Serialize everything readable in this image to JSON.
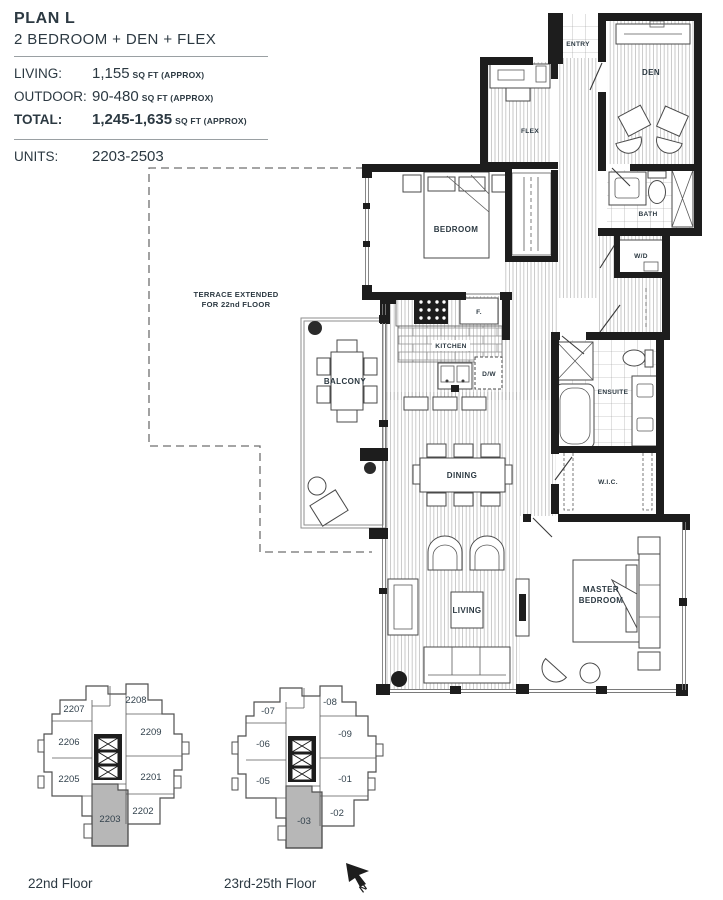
{
  "header": {
    "plan_name": "PLAN L",
    "plan_type": "2 BEDROOM + DEN + FLEX",
    "living_label": "LIVING:",
    "living_value": "1,155",
    "living_unit": "SQ FT (APPROX)",
    "outdoor_label": "OUTDOOR:",
    "outdoor_value": "90-480",
    "outdoor_unit": "SQ FT (APPROX)",
    "total_label": "TOTAL:",
    "total_value": "1,245-1,635",
    "total_unit": "SQ FT (APPROX)",
    "units_label": "UNITS:",
    "units_value": "2203-2503"
  },
  "floorplan": {
    "rooms": {
      "entry": "ENTRY",
      "den": "DEN",
      "flex": "FLEX",
      "bath": "BATH",
      "wd": "W/D",
      "bedroom": "BEDROOM",
      "kitchen": "KITCHEN",
      "fridge": "F.",
      "dishwasher": "D/W",
      "balcony": "BALCONY",
      "dining": "DINING",
      "ensuite": "ENSUITE",
      "wic": "W.I.C.",
      "living": "LIVING",
      "master_line1": "MASTER",
      "master_line2": "BEDROOM"
    },
    "terrace_note_line1": "TERRACE EXTENDED",
    "terrace_note_line2": "FOR 22nd FLOOR"
  },
  "keyplans": [
    {
      "caption": "22nd Floor",
      "units": [
        "2207",
        "2208",
        "2206",
        "2209",
        "2205",
        "2201",
        "2203",
        "2202"
      ],
      "highlighted_unit": "2203"
    },
    {
      "caption": "23rd-25th Floor",
      "units": [
        "-07",
        "-08",
        "-06",
        "-09",
        "-05",
        "-01",
        "-03",
        "-02"
      ],
      "highlighted_unit": "-03"
    }
  ],
  "compass": {
    "north_label": "N"
  },
  "colors": {
    "text": "#2c3942",
    "wall": "#1d1d1d",
    "highlight_unit": "#b7b7b7",
    "background": "#ffffff"
  }
}
